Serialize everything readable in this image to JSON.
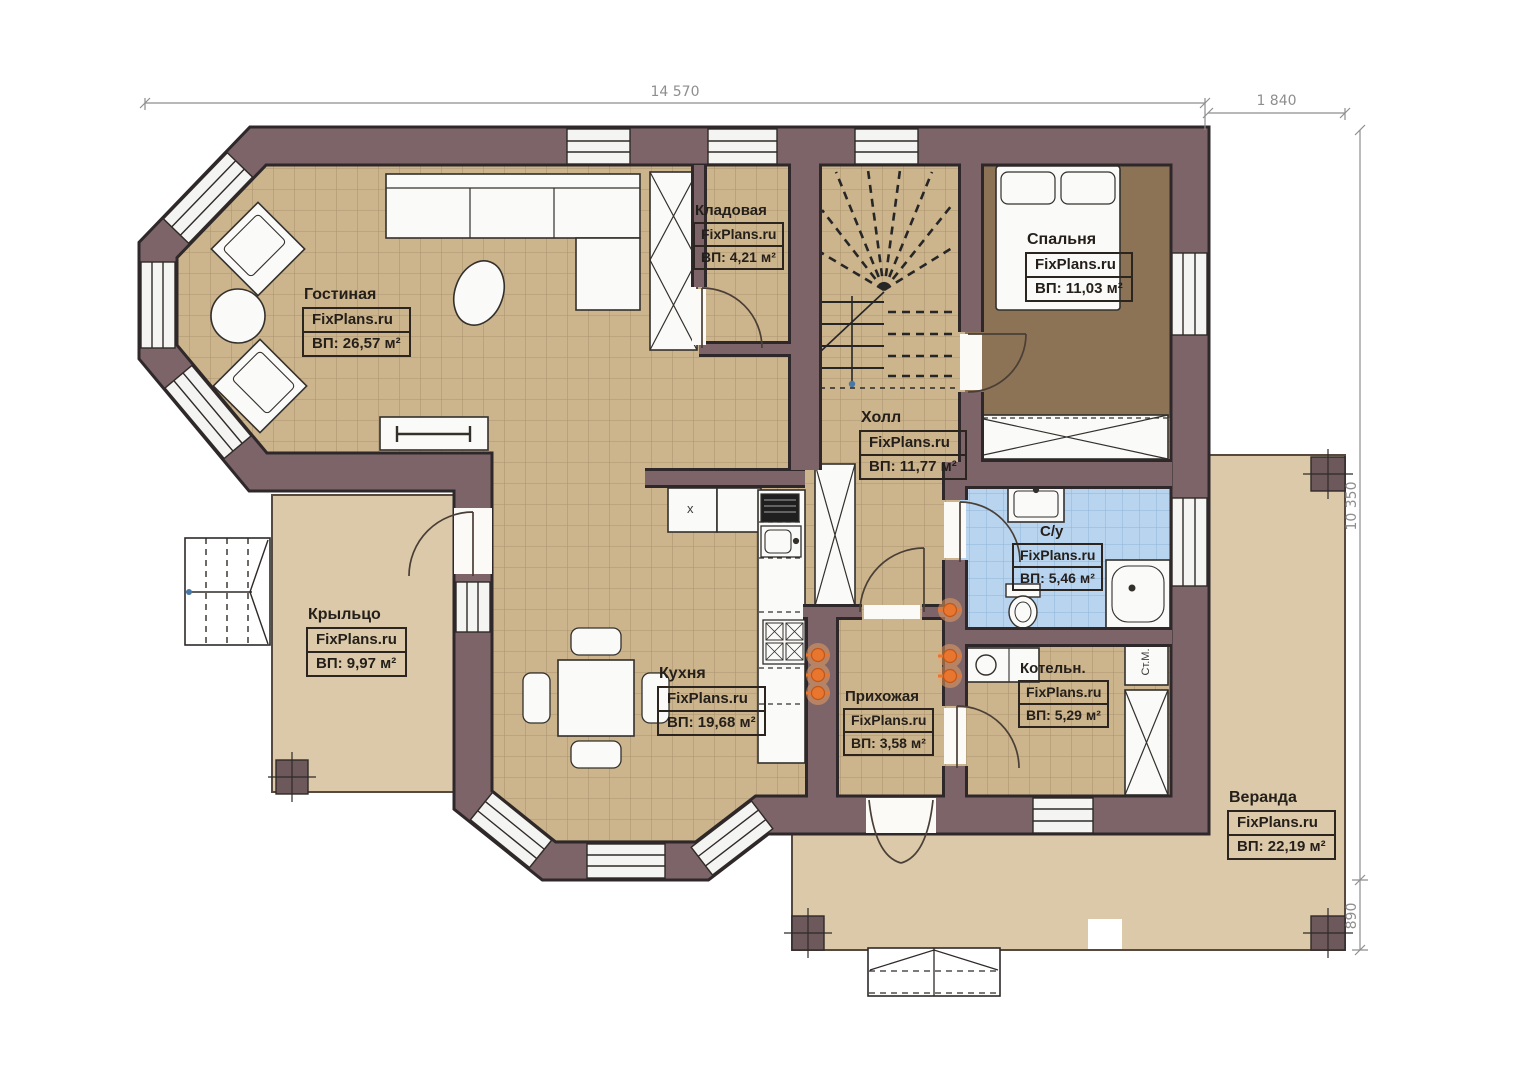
{
  "plan": {
    "brand": "FixPlans.ru",
    "rooms": [
      {
        "name": "Гостиная",
        "area": "ВП: 26,57 м²"
      },
      {
        "name": "Кладовая",
        "area": "ВП: 4,21 м²"
      },
      {
        "name": "Спальня",
        "area": "ВП: 11,03 м²"
      },
      {
        "name": "Холл",
        "area": "ВП: 11,77 м²"
      },
      {
        "name": "С/у",
        "area": "ВП: 5,46 м²"
      },
      {
        "name": "Крыльцо",
        "area": "ВП: 9,97 м²"
      },
      {
        "name": "Кухня",
        "area": "ВП: 19,68 м²"
      },
      {
        "name": "Прихожая",
        "area": "ВП: 3,58 м²"
      },
      {
        "name": "Котельн.",
        "area": "ВП: 5,29 м²"
      },
      {
        "name": "Веранда",
        "area": "ВП: 22,19 м²"
      }
    ],
    "dimensions": {
      "top": "14 570",
      "top_right": "1 840",
      "right": "10 350",
      "bottom_right": "890"
    },
    "appliances": {
      "washing_machine": "Ст.М.",
      "kitchen_unit_mark": "х"
    },
    "colors": {
      "wall": "#7c6468",
      "floor_tile": "#ccb48c",
      "bedroom_floor": "#8c7355",
      "bath_tile": "#b9d4ef",
      "outdoor": "#dbc9a9",
      "radiator": "#e8762f"
    }
  }
}
